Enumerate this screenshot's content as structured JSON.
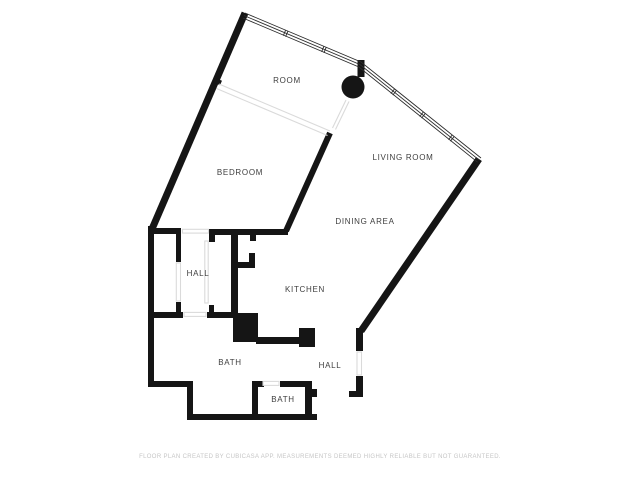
{
  "plan": {
    "rooms": [
      {
        "label": "ROOM"
      },
      {
        "label": "BEDROOM"
      },
      {
        "label": "LIVING ROOM"
      },
      {
        "label": "DINING AREA"
      },
      {
        "label": "HALL"
      },
      {
        "label": "KITCHEN"
      },
      {
        "label": "BATH"
      },
      {
        "label": "HALL"
      },
      {
        "label": "BATH"
      }
    ],
    "footer": "FLOOR PLAN CREATED BY CUBICASA APP. MEASUREMENTS DEEMED HIGHLY RELIABLE BUT NOT GUARANTEED.",
    "colors": {
      "wall": "#151515",
      "label": "#3e3e3e",
      "opening": "#dadada",
      "footer": "#c6c6c6",
      "background": "#ffffff"
    }
  }
}
